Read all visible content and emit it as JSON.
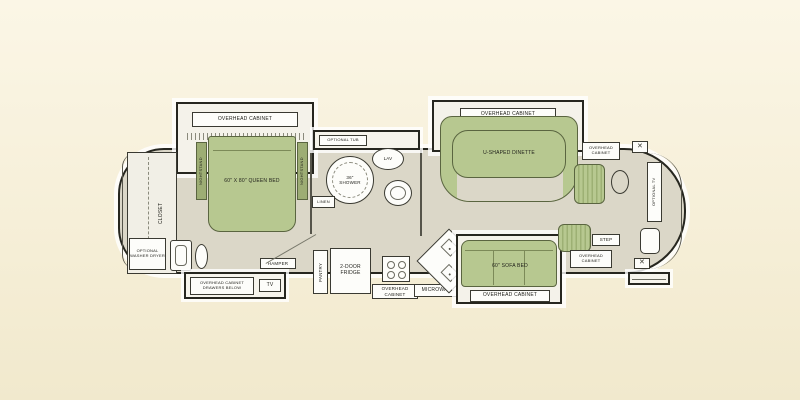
{
  "title": "RV motorhome floor plan",
  "labels": {
    "bedroom_overhead": "OVERHEAD CABINET",
    "queen_bed": "60\" X 80\" QUEEN BED",
    "nightstand_left": "NIGHTSTAND",
    "nightstand_right": "NIGHTSTAND",
    "closet": "CLOSET",
    "washer": "OPTIONAL WASHER DRYER",
    "hamper": "HAMPER",
    "dresser": "OVERHEAD CABINET DRAWERS BELOW",
    "bedroom_tv": "TV",
    "optional_tub": "OPTIONAL TUB",
    "shower": "36\" SHOWER",
    "lav": "LAV",
    "linen": "LINEN",
    "pantry": "PANTRY",
    "fridge": "2-DOOR FRIDGE",
    "range_overhead": "OVERHEAD CABINET",
    "microwave": "MICROWAVE",
    "dinette_overhead": "OVERHEAD CABINET",
    "dinette": "U-SHAPED DINETTE",
    "sofa": "60\" SOFA BED",
    "sofa_overhead": "OVERHEAD CABINET",
    "front_overhead_top": "OVERHEAD CABINET",
    "front_overhead_bottom": "OVERHEAD CABINET",
    "step": "STEP",
    "front_tv": "OPTIONAL TV",
    "x_marker": "✕"
  },
  "colors": {
    "background": "#f6efd8",
    "floor": "#dbd7c8",
    "furniture_green": "#b7c890",
    "outline": "#26261f",
    "fixture_white": "#fdfdfa"
  }
}
